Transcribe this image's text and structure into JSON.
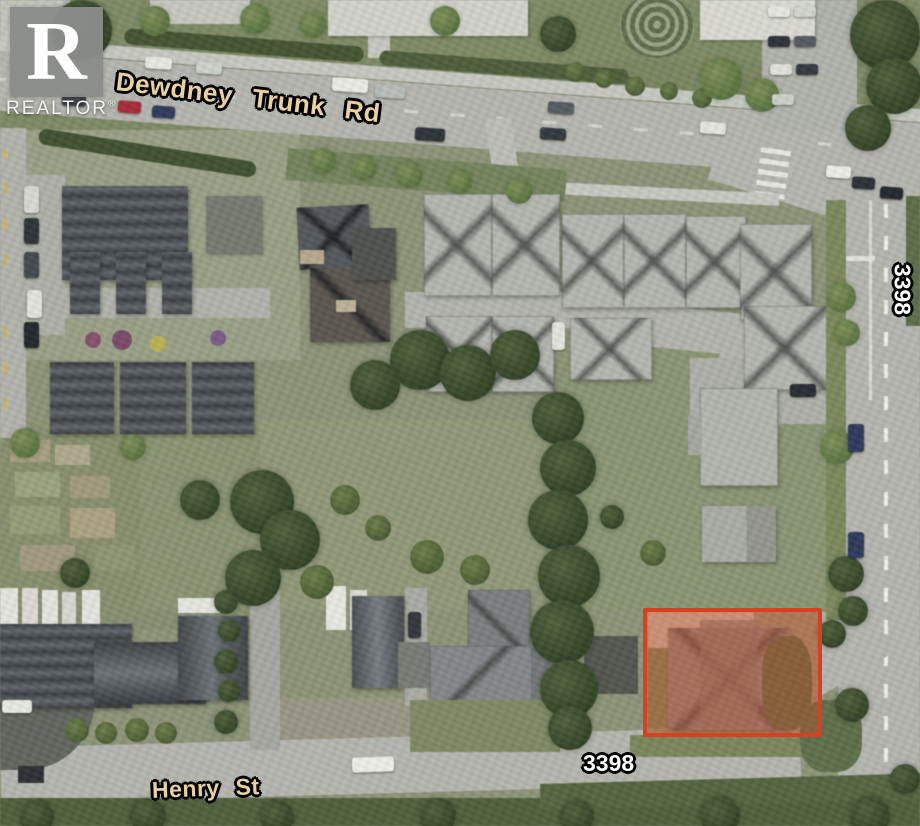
{
  "branding": {
    "logo_letter": "R",
    "agency_mark": "REALTOR",
    "registered_symbol": "®"
  },
  "labels": {
    "street_main": "Dewdney Trunk Rd",
    "street_bottom": "Henry St",
    "address_east": "3398",
    "address_south": "3398"
  },
  "highlight": {
    "label": "subject-property",
    "outline_color": "#d8401f",
    "fill_color": "rgba(219,70,35,0.32)"
  },
  "colors": {
    "street_label": "#e8d19b",
    "address_label": "#ffffff",
    "logo_background": "rgba(138,140,137,0.95)",
    "logo_foreground": "#ffffff"
  }
}
